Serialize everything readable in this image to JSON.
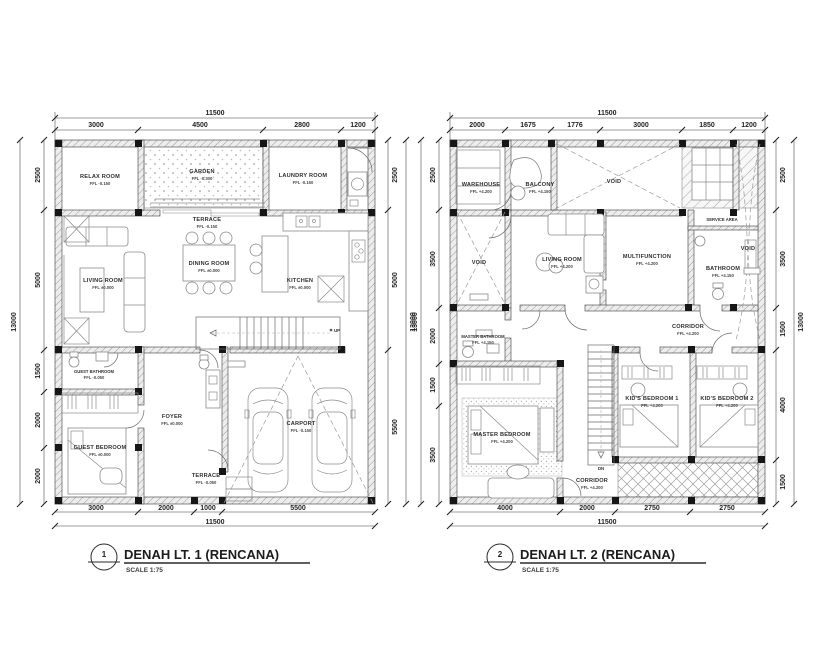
{
  "plan1": {
    "title_number": "1",
    "title": "DENAH LT. 1 (RENCANA)",
    "scale": "SCALE 1:75",
    "stair_label": "UP",
    "dims": {
      "top_total": "11500",
      "top": [
        "3000",
        "4500",
        "2800",
        "1200"
      ],
      "bottom": [
        "3000",
        "2000",
        "1000",
        "5500"
      ],
      "bottom_total": "11500",
      "left": [
        "2500",
        "5000",
        "1500",
        "2000",
        "2000"
      ],
      "left_total": "13000",
      "right": [
        "2500",
        "5000",
        "5500"
      ],
      "right_total": "13000"
    },
    "rooms": [
      {
        "name": "RELAX ROOM",
        "ffl": "FFL -0.150"
      },
      {
        "name": "GARDEN",
        "ffl": "FFL -0.300"
      },
      {
        "name": "TERRACE",
        "ffl": "FFL -0.150"
      },
      {
        "name": "LAUNDRY ROOM",
        "ffl": "FFL -0.150"
      },
      {
        "name": "LIVING ROOM",
        "ffl": "FFL ±0.000"
      },
      {
        "name": "DINING ROOM",
        "ffl": "FFL ±0.000"
      },
      {
        "name": "KITCHEN",
        "ffl": "FFL ±0.000"
      },
      {
        "name": "GUEST BATHROOM",
        "ffl": "FFL -0.050"
      },
      {
        "name": "FOYER",
        "ffl": "FFL ±0.000"
      },
      {
        "name": "GUEST BEDROOM",
        "ffl": "FFL ±0.000"
      },
      {
        "name": "TERRACE",
        "ffl": "FFL -0.050"
      },
      {
        "name": "CARPORT",
        "ffl": "FFL -0.150"
      }
    ]
  },
  "plan2": {
    "title_number": "2",
    "title": "DENAH LT. 2 (RENCANA)",
    "scale": "SCALE 1:75",
    "stair_label": "DN",
    "dims": {
      "top_total": "11500",
      "top": [
        "2000",
        "1675",
        "1776",
        "3000",
        "1850",
        "1200"
      ],
      "bottom": [
        "4000",
        "2000",
        "2750",
        "2750"
      ],
      "bottom_total": "11500",
      "left": [
        "2500",
        "3500",
        "2000",
        "1500",
        "3500"
      ],
      "left_total": "13000",
      "right": [
        "2500",
        "3500",
        "1500",
        "4000",
        "1500"
      ],
      "right_total": "13000"
    },
    "rooms": [
      {
        "name": "WAREHOUSE",
        "ffl": "FFL +4.200"
      },
      {
        "name": "BALCONY",
        "ffl": "FFL +4.150"
      },
      {
        "name": "VOID",
        "ffl": ""
      },
      {
        "name": "SERVICE AREA",
        "ffl": ""
      },
      {
        "name": "VOID",
        "ffl": ""
      },
      {
        "name": "VOID",
        "ffl": ""
      },
      {
        "name": "LIVING ROOM",
        "ffl": "FFL +4.200"
      },
      {
        "name": "MULTIFUNCTION",
        "ffl": "FFL +4.200"
      },
      {
        "name": "BATHROOM",
        "ffl": "FFL +4.150"
      },
      {
        "name": "CORRIDOR",
        "ffl": "FFL +4.200"
      },
      {
        "name": "MASTER BATHROOM",
        "ffl": "FFL +4.150"
      },
      {
        "name": "MASTER BEDROOM",
        "ffl": "FFL +4.200"
      },
      {
        "name": "KID'S BEDROOM 1",
        "ffl": "FFL +4.200"
      },
      {
        "name": "KID'S BEDROOM 2",
        "ffl": "FFL +4.200"
      },
      {
        "name": "CORRIDOR",
        "ffl": "FFL +4.200"
      }
    ]
  }
}
